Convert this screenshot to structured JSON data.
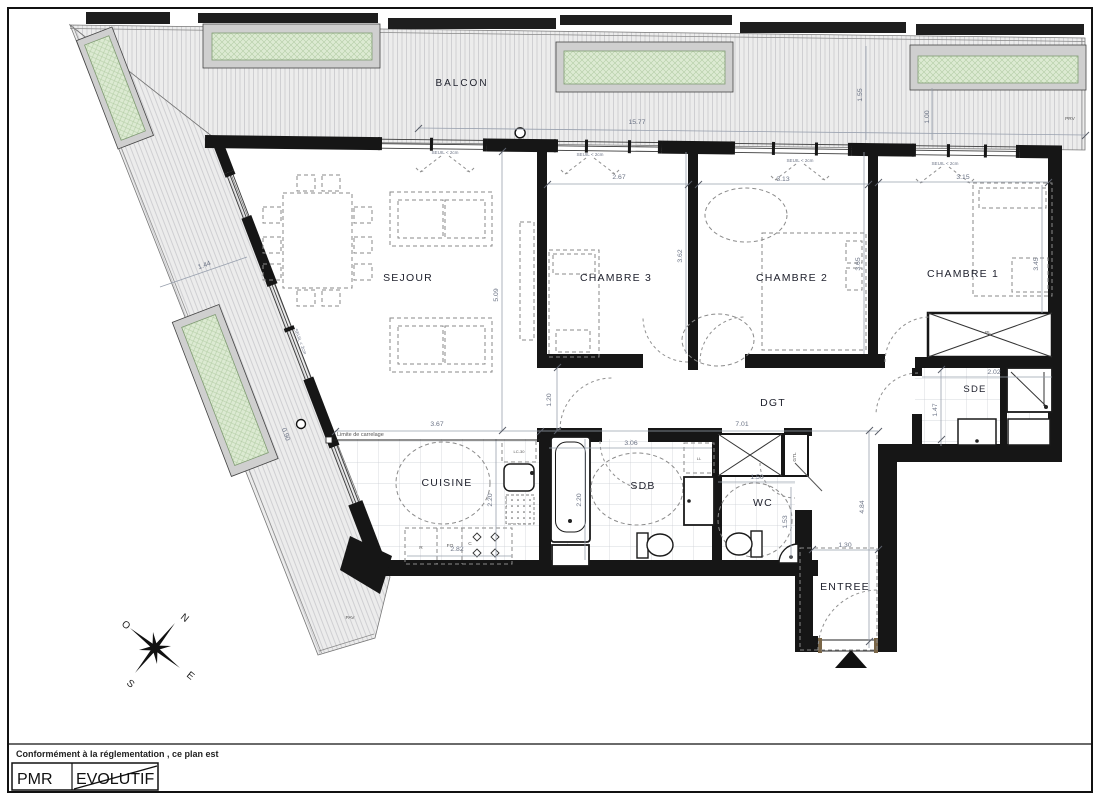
{
  "plan": {
    "balcony_label": "BALCON",
    "rooms": {
      "sejour": "SEJOUR",
      "chambre3": "CHAMBRE 3",
      "chambre2": "CHAMBRE 2",
      "chambre1": "CHAMBRE 1",
      "cuisine": "CUISINE",
      "sdb": "SDB",
      "wc": "WC",
      "dgt": "DGT",
      "sde": "SDE",
      "entree": "ENTREE"
    },
    "annotations": {
      "seuil": "SEUIL < 2cm",
      "limite_carrelage": "Limite de carrelage",
      "placard": "PL",
      "lave_linge": "LL",
      "lave_vaisselle": "LC-30",
      "gaine_technique": "GTL",
      "refrigerateur": "R",
      "four": "FO",
      "cuisson": "C",
      "pav": "PAV",
      "prv": "PRV"
    },
    "dimensions": {
      "balcon_length": "15.77",
      "chambre3_width": "2.67",
      "chambre2_width": "3.13",
      "chambre1_width": "3.15",
      "sejour_depth": "5.09",
      "chambre2_depth_left": "3.62",
      "chambre2_depth_right": "3.65",
      "chambre1_depth": "3.45",
      "cuisine_width": "3.67",
      "sdb_width": "3.06",
      "plan_travail": "2.82",
      "cuisine_depth": "2.20",
      "sdb_depth": "2.20",
      "porte_sejour": "1.20",
      "dgt_length": "7.01",
      "wc_width": "1.50",
      "wc_depth": "1.53",
      "entree_length": "4.84",
      "entree_width": "1.30",
      "sde_depth": "1.47",
      "sde_width": "2.02",
      "balcon_diag_width": "1.44",
      "balcon_right_depth1": "1.55",
      "balcon_right_depth2": "1.00",
      "balcon_diag_width2": "0.90"
    },
    "compass": {
      "n": "N",
      "e": "E",
      "s": "S",
      "o": "O"
    },
    "footer": {
      "note": "Conformément à la réglementation , ce plan est",
      "pmr": "PMR",
      "evolutif": "EVOLUTIF"
    },
    "colors": {
      "wall": "#161616",
      "planter_green": "#dcead2",
      "dim_text": "#6b7385"
    }
  }
}
